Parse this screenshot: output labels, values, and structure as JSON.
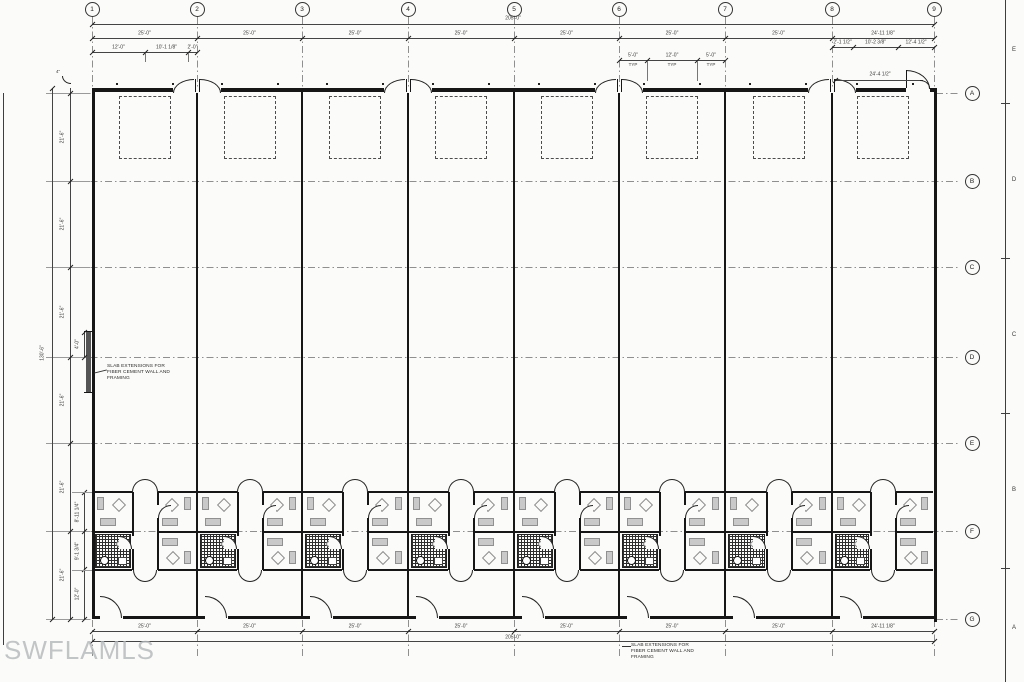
{
  "watermark": "SWFLAMLS",
  "sheet": {
    "zone_letters": [
      "E",
      "D",
      "C",
      "B",
      "A"
    ]
  },
  "grid": {
    "column_labels": [
      "1",
      "2",
      "3",
      "4",
      "5",
      "6",
      "7",
      "8",
      "9"
    ],
    "column_x": [
      92,
      197,
      302,
      408,
      514,
      619,
      725,
      832,
      934
    ],
    "row_labels": [
      "A",
      "B",
      "C",
      "D",
      "E",
      "F",
      "G"
    ],
    "row_y": [
      93,
      181,
      267,
      357,
      443,
      531,
      619
    ]
  },
  "dimensions": {
    "overall_width": "205'-0\"",
    "overall_height": "130'-6\"",
    "bay_labels": [
      "25'-0\"",
      "25'-0\"",
      "25'-0\"",
      "25'-0\"",
      "25'-0\"",
      "25'-0\"",
      "25'-0\"",
      "24'-11 1/8\""
    ],
    "row_segment_labels": [
      "21'-6\"",
      "21'-6\"",
      "21'-6\"",
      "21'-6\"",
      "21'-6\"",
      "21'-6\""
    ],
    "office_depth_labels": [
      "8'-11 1/4\"",
      "9'-1 3/4\"",
      "12'-0\""
    ],
    "bay1_sub": [
      "12'-0\"",
      "10'-1 1/8\"",
      "2'-0\""
    ],
    "bay6_sub": [
      "5'-0\"",
      "12'-0\"",
      "5'-0\""
    ],
    "bay6_sub_suffix": "TYP",
    "bay8_sub": [
      "2'-1 1/2\"",
      "10'-2 3/8\"",
      "12'-4 1/2\""
    ],
    "corner_dim": "24'-4 1/2\"",
    "slab_offset_dim": "4'-0\"",
    "corner_offset_dim": "4\""
  },
  "notes": {
    "slab_left": "SLAB EXTENSIONS FOR FIBER CEMENT WALL AND FRAMING",
    "slab_bottom": "SLAB EXTENSIONS FOR FIBER CEMENT WALL AND FRAMING"
  },
  "units": {
    "count": 8
  }
}
